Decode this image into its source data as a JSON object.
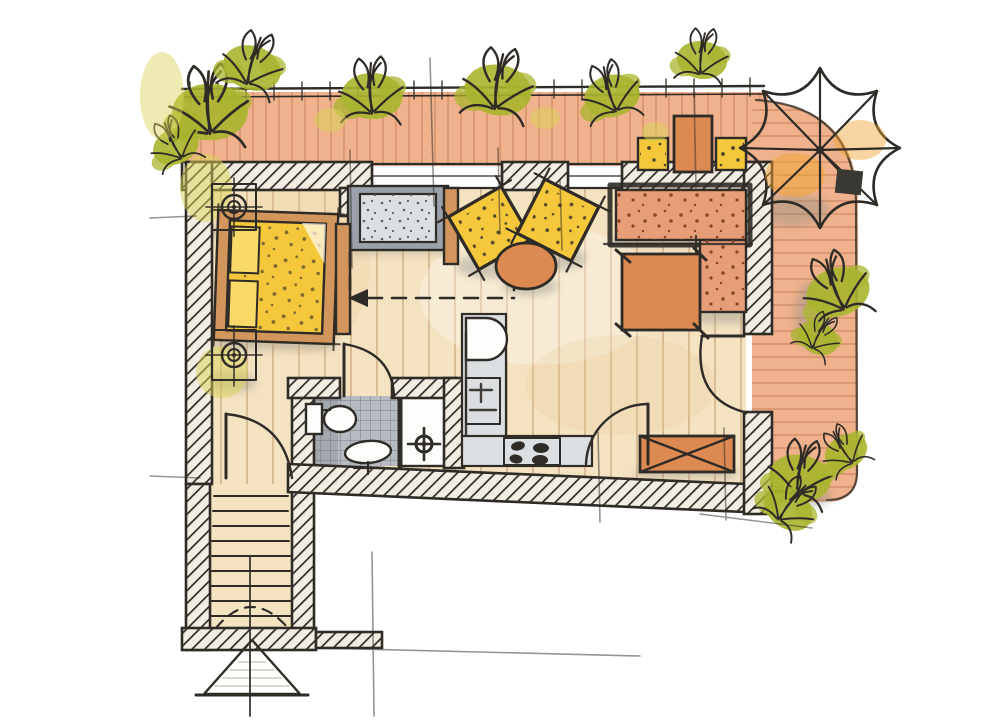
{
  "scene": {
    "kind": "hand-drawn watercolor apartment floor plan, top-down view",
    "visible_text": "none"
  },
  "palette": {
    "paper": "#ffffff",
    "ink": "#2f2b27",
    "hatch_bg": "#f2ede3",
    "floor_wood": "#f4e3c1",
    "plank_line": "#c2996b",
    "terrace_deck": "#f0b28c",
    "deck_line": "#cf8a62",
    "furniture_yellow": "#f5c83c",
    "pillow_yellow": "#f9d968",
    "wood_frame": "#d2955c",
    "accent_orange": "#dd8a52",
    "sofa_salmon": "#e79d77",
    "gray_light": "#dcdfe1",
    "gray_mid": "#9aa1a8",
    "tile_gray": "#b7bcc2",
    "tile_line": "#63676c",
    "plant_green": "#a9b52f",
    "plant_tint": "#d8d355",
    "shadow": "#8e8d84",
    "white_fixture": "#fdfdfb"
  },
  "counts": {
    "parasol_ribs": 8,
    "cooktop_burners": 4,
    "indoor_armchairs": 2,
    "outdoor_chairs": 2,
    "stair_treads": 9,
    "railing_plant_clusters": 5
  },
  "rooms": [
    {
      "name": "north-terrace",
      "items": [
        "railing",
        "deck-boards",
        "bushes",
        "outdoor-chair",
        "outdoor-table",
        "outdoor-chair",
        "parasol"
      ]
    },
    {
      "name": "bedroom",
      "items": [
        "double-bed",
        "pillows",
        "nightstand-with-lamp-north",
        "nightstand-with-lamp-south",
        "gray-dresser",
        "wardrobe-panel",
        "sliding-door-dashed-arrow"
      ]
    },
    {
      "name": "living-room",
      "items": [
        "armchair",
        "armchair",
        "round-side-table",
        "l-shaped-corner-sofa",
        "coffee-table",
        "storage-chest",
        "terrace-door-swing"
      ]
    },
    {
      "name": "kitchen",
      "items": [
        "sink-unit",
        "appliance-unit",
        "counter",
        "cooktop",
        "cabinet-door-swing"
      ]
    },
    {
      "name": "bathroom",
      "items": [
        "toilet",
        "washbasin",
        "shower",
        "tiled-floor",
        "door-swing"
      ]
    },
    {
      "name": "entry-hall-stair",
      "items": [
        "entrance-door-swing",
        "stair-treads",
        "dashed-door-swing",
        "entry-direction-arrow"
      ]
    },
    {
      "name": "east-terrace",
      "items": [
        "deck-boards",
        "bushes",
        "parasol-base"
      ]
    }
  ]
}
